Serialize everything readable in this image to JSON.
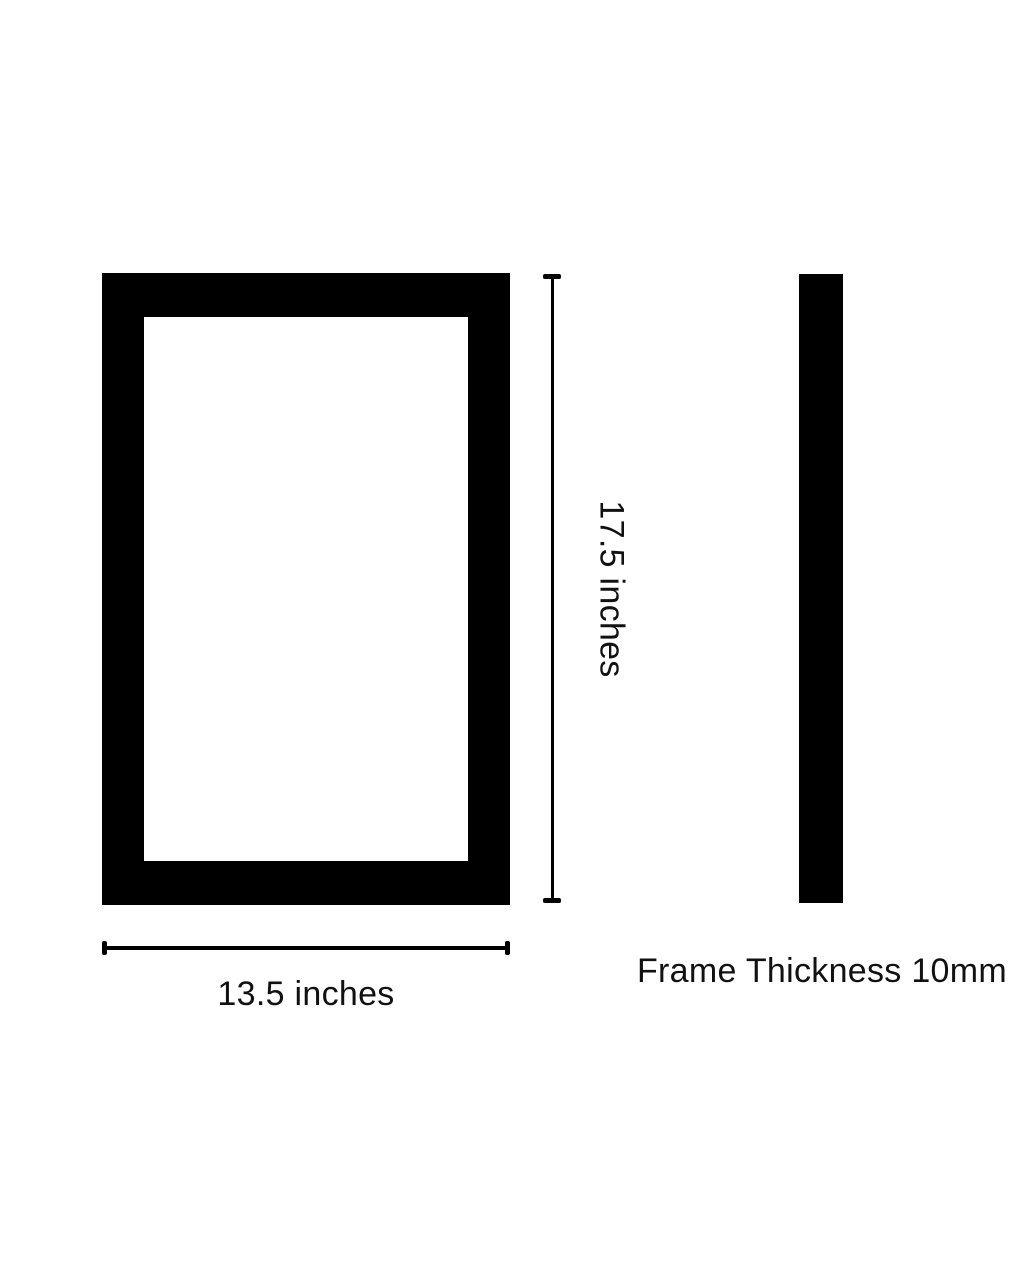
{
  "page": {
    "background_color": "#ffffff"
  },
  "diagram": {
    "type": "picture-frame-dimension-diagram",
    "frame_color": "#000000",
    "text_color": "#111111",
    "front_view": {
      "height_label": "17.5 inches",
      "width_label": "13.5 inches"
    },
    "side_view": {
      "thickness_label": "Frame Thickness 10mm"
    },
    "dimensions": {
      "height_inches": 17.5,
      "width_inches": 13.5,
      "thickness_mm": 10
    }
  }
}
